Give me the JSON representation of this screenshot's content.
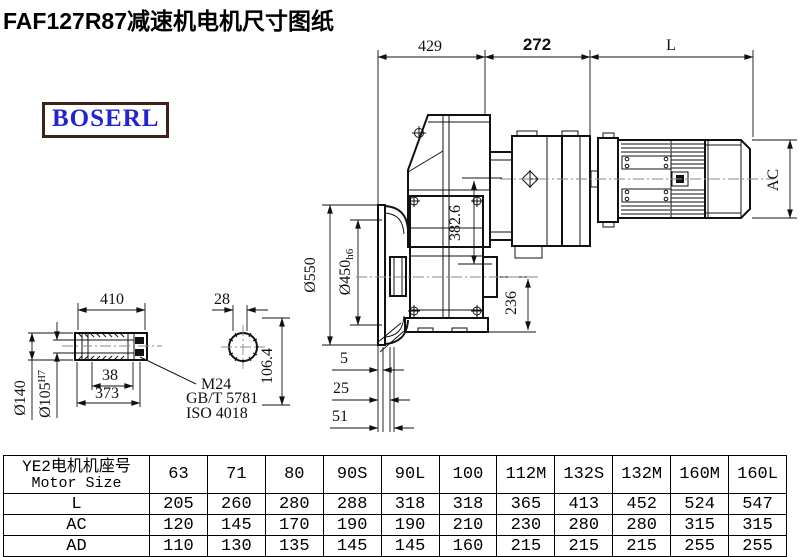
{
  "title": "FAF127R87减速机电机尺寸图纸",
  "logo": {
    "text": "BOSERL",
    "text_color": "#2323cf",
    "border_color": "#3d221c"
  },
  "drawing": {
    "top_dims": {
      "w429": "429",
      "w272": "272",
      "wL": "L"
    },
    "main_dims": {
      "phi550": "Ø550",
      "phi450": "Ø450",
      "phi450tol": "h6",
      "h382": "382.6",
      "h236": "236",
      "ac": "AC",
      "s5": "5",
      "s25": "25",
      "s51": "51"
    },
    "shaft_dims": {
      "len410": "410",
      "b38": "38",
      "b373": "373",
      "phi140": "Ø140",
      "phi105": "Ø105",
      "phi105tol": "H7",
      "key28": "28",
      "h106": "106.4",
      "note1": "M24",
      "note2": "GB/T 5781",
      "note3": "ISO 4018"
    }
  },
  "table": {
    "header_cn": "YE2电机机座号",
    "header_en": "Motor Size",
    "columns": [
      "63",
      "71",
      "80",
      "90S",
      "90L",
      "100",
      "112M",
      "132S",
      "132M",
      "160M",
      "160L"
    ],
    "rows": [
      {
        "label": "L",
        "values": [
          "205",
          "260",
          "280",
          "288",
          "318",
          "318",
          "365",
          "413",
          "452",
          "524",
          "547"
        ]
      },
      {
        "label": "AC",
        "values": [
          "120",
          "145",
          "170",
          "190",
          "190",
          "210",
          "230",
          "280",
          "280",
          "315",
          "315"
        ]
      },
      {
        "label": "AD",
        "values": [
          "110",
          "130",
          "135",
          "145",
          "145",
          "160",
          "215",
          "215",
          "215",
          "255",
          "255"
        ]
      }
    ]
  }
}
